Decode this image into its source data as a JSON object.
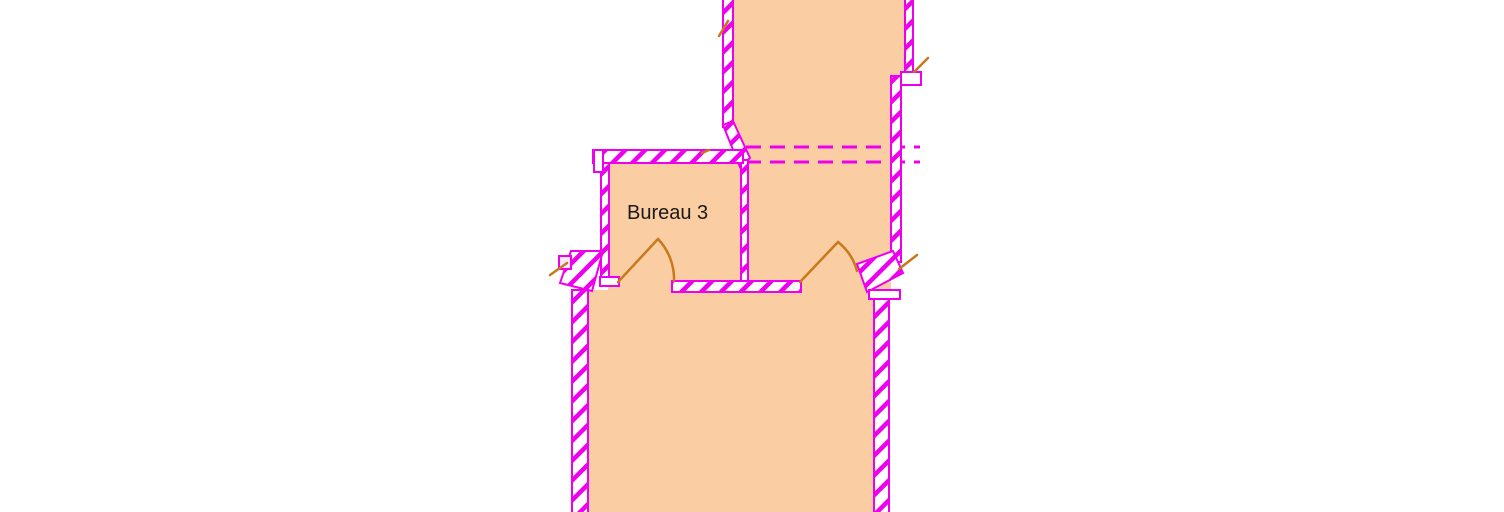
{
  "colors": {
    "background": "#ffffff",
    "floor": "#facda2",
    "wall": "#ee00ee",
    "door": "#c8791b",
    "ink": "#1a1a1a",
    "notch": "#fce8fc"
  },
  "rooms": [
    {
      "label": "Bureau 3"
    }
  ]
}
